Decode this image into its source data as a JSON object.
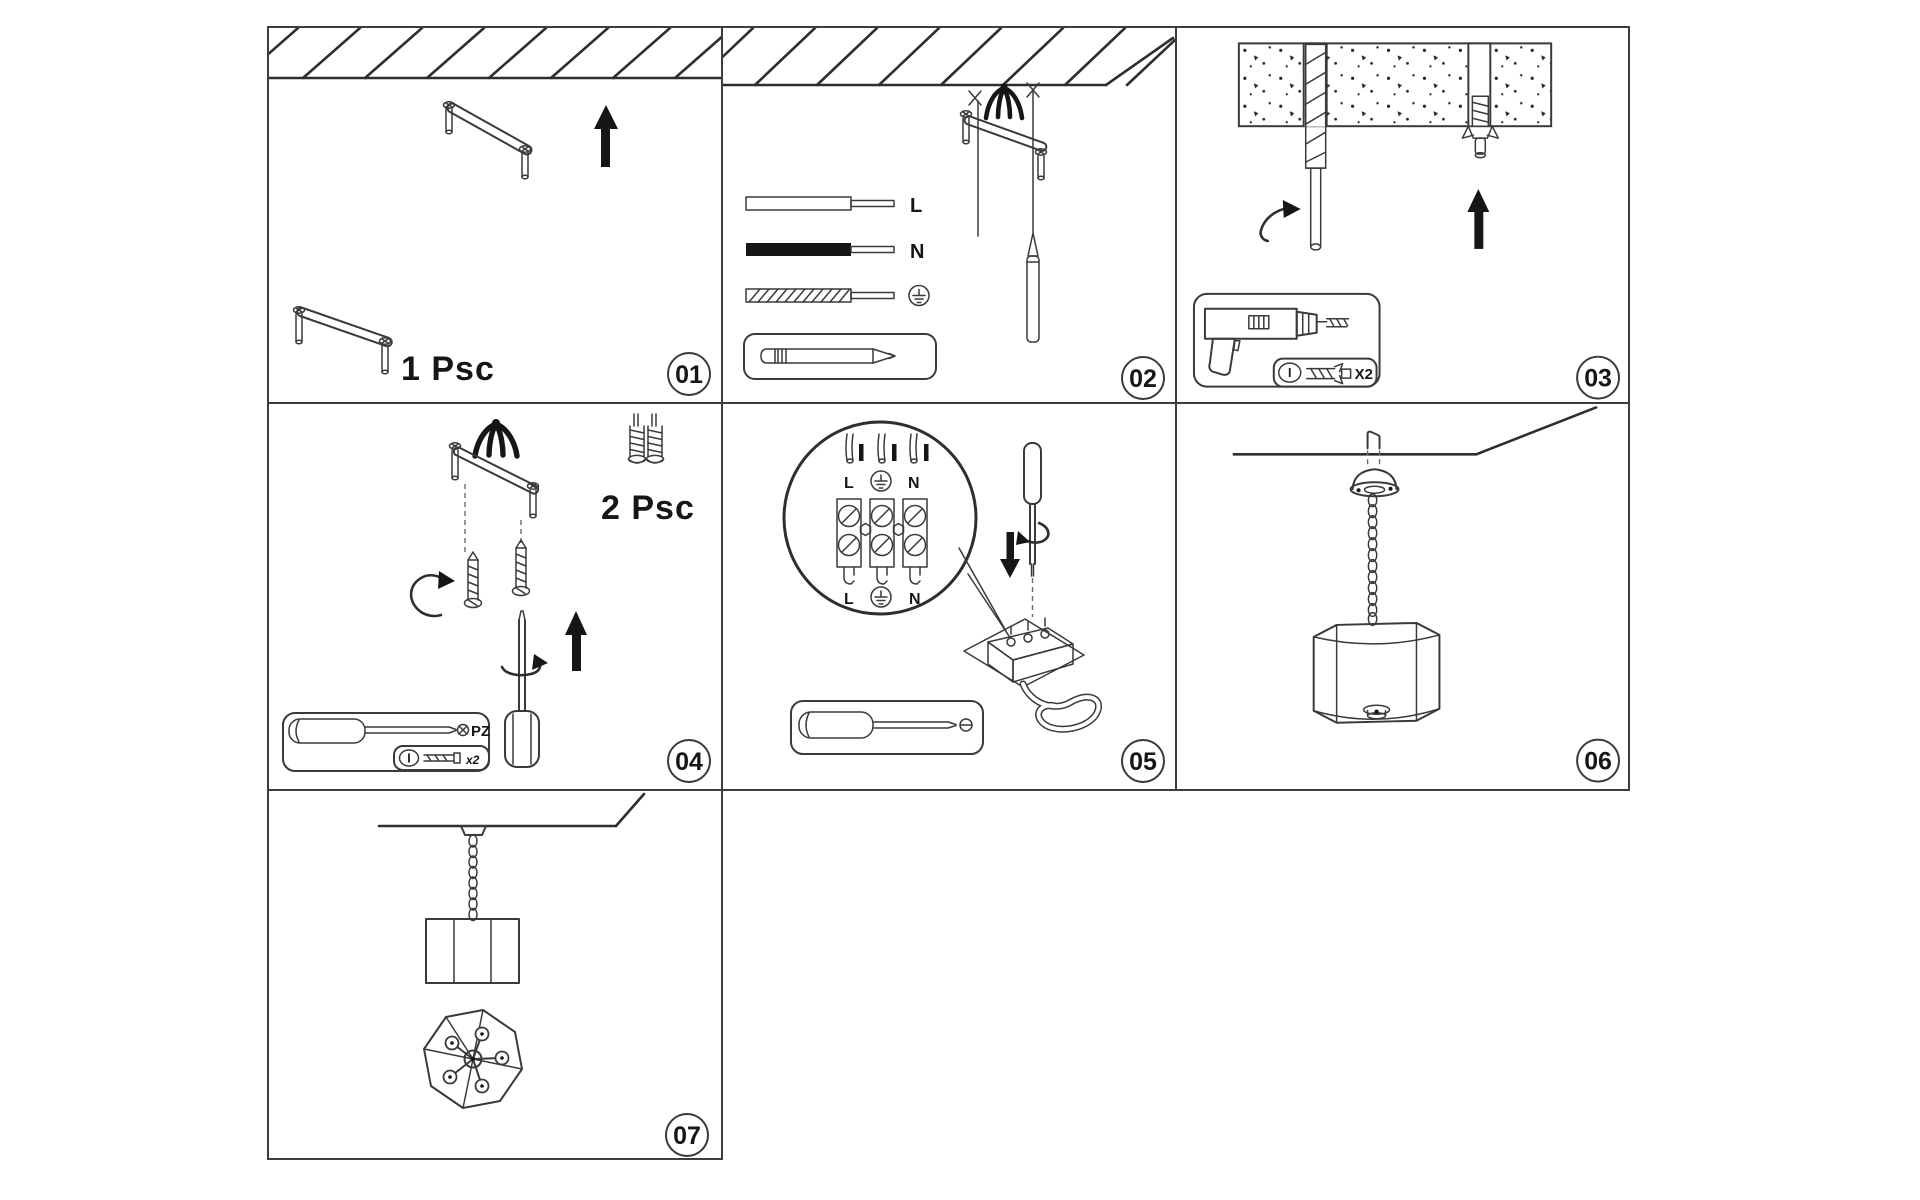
{
  "sheet": {
    "type": "pendant-lamp-installation-instructions",
    "line_color": "#3a3a3a",
    "ink_color": "#161616",
    "background": "#ffffff"
  },
  "steps": {
    "s1": {
      "number": "01",
      "quantity": "1 Psc"
    },
    "s2": {
      "number": "02",
      "label_live": "L",
      "label_neutral": "N"
    },
    "s3": {
      "number": "03",
      "drill_key": "I",
      "anchor_count": "X2"
    },
    "s4": {
      "number": "04",
      "quantity": "2 Psc",
      "screwdriver_type": "PZ",
      "screw_key": "I",
      "screw_count": "x2"
    },
    "s5": {
      "number": "05",
      "terminal_top_live": "L",
      "terminal_top_neutral": "N",
      "terminal_bottom_live": "L",
      "terminal_bottom_neutral": "N"
    },
    "s6": {
      "number": "06"
    },
    "s7": {
      "number": "07"
    }
  }
}
